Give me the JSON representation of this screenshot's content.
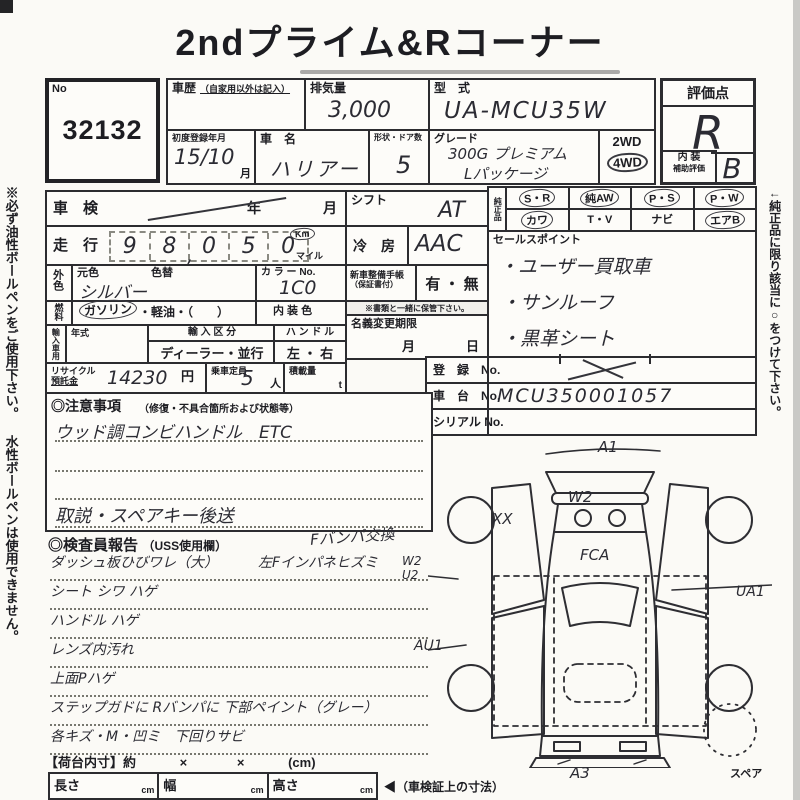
{
  "page": {
    "title": "2ndプライム&Rコーナー",
    "left_margin_note": "※必ず油性ボールペンをご使用下さい。 水性ボールペンは使用できません。",
    "right_margin_note": "←純正品に限り該当に○をつけて下さい。",
    "ink_color": "#2c2c30",
    "paper_color": "#fbfaf6"
  },
  "lot": {
    "label": "No",
    "number": "32132"
  },
  "top": {
    "history_label_1": "車歴",
    "history_label_2": "（自家用以外は記入）",
    "displacement_label": "排気量",
    "displacement_value": "3,000",
    "model_label": "型　式",
    "model_value": "UA-MCU35W",
    "first_reg_label": "初度登録年月",
    "first_reg_value": "15∕10",
    "first_reg_unit": "月",
    "name_label": "車　名",
    "name_value": "ハリアー",
    "shape_label": "形状・ドア数",
    "shape_value": "5",
    "grade_label": "グレード",
    "grade_value_1": "300G プレミアム",
    "grade_value_2": "Lパッケージ",
    "wd2": "2WD",
    "wd4": "4WD"
  },
  "score": {
    "label": "評価点",
    "value": "R",
    "interior_label_1": "内 装",
    "interior_label_2": "補助評価",
    "interior_value": "B"
  },
  "left": {
    "shaken_label": "車　検",
    "year_label": "年",
    "month_label": "月",
    "mileage_label": "走　行",
    "mileage": {
      "d": [
        "9",
        "8",
        "0",
        "5",
        "0"
      ],
      "comma": ","
    },
    "unit_km": "Km",
    "unit_mile": "マイル",
    "ext_color_label": "外色",
    "base_color_label": "元色",
    "color_change_label": "色替",
    "base_color_value": "シルバー",
    "color_no_label": "カ ラ ー No.",
    "color_no_value": "1C0",
    "fuel_label": "燃料",
    "fuel_opt_main": "ガソリン",
    "fuel_opt_rest": "・軽油・（　　）",
    "interior_color_label": "内 装 色",
    "import_label": "輸入車用",
    "year2_label": "年式",
    "import_div_label": "輸 入 区 分",
    "import_div_value": "ディーラー・並行",
    "handle_label": "ハ ン ド ル",
    "handle_value": "左 ・ 右",
    "recycle_label_1": "リサイクル",
    "recycle_label_2": "預託金",
    "recycle_value": "14230",
    "recycle_unit": "円",
    "capacity_label": "乗車定員",
    "capacity_value": "5",
    "capacity_unit": "人",
    "load_label": "積載量",
    "load_unit": "t"
  },
  "mid": {
    "shift_label": "シフト",
    "shift_value": "AT",
    "ac_label": "冷　房",
    "ac_value": "AAC",
    "manual_label_1": "新車整備手帳",
    "manual_label_2": "（保証書付）",
    "manual_value": "有 ・ 無",
    "manual_note": "※書類と一緒に保管下さい。",
    "transfer_label": "名義変更期限",
    "transfer_month": "月",
    "transfer_day": "日"
  },
  "oem": {
    "group_label": "純正品",
    "cells": [
      {
        "top": "S・R",
        "bottom": "カワ"
      },
      {
        "top": "純AW",
        "bottom": "T・V"
      },
      {
        "top": "P・S",
        "bottom": "ナビ"
      },
      {
        "top": "P・W",
        "bottom": "エアB"
      }
    ]
  },
  "sales": {
    "label": "セールスポイント",
    "items": [
      "・ユーザー買取車",
      "・サンルーフ",
      "・黒革シート"
    ]
  },
  "reg": {
    "reg_label": "登　録　No.",
    "chassis_label": "車　台　No.",
    "chassis_value": "MCU350001057",
    "serial_label": "シリアル No."
  },
  "cautions": {
    "label": "◎注意事項",
    "label_sub": "（修復・不具合箇所および状態等）",
    "line_1": "ウッド調コンビハンドル　ETC",
    "line_4": "取説・スペアキー後送"
  },
  "inspector": {
    "label": "◎検査員報告",
    "label_sub": "（USS使用欄）",
    "header_note": "Fバンパ交換",
    "lines": [
      {
        "left": "ダッシュ板ひびワレ（大）",
        "right": "左Fインパネヒズミ"
      },
      {
        "left": "シート シワ ハゲ",
        "right": ""
      },
      {
        "left": "ハンドル ハゲ",
        "right": ""
      },
      {
        "left": "レンズ内汚れ",
        "right": ""
      },
      {
        "left": "上面Pハゲ",
        "right": ""
      },
      {
        "left": "ステップガドに Rバンパに 下部ペイント（グレー）",
        "right": ""
      },
      {
        "left": "各キズ・M・凹ミ　下回りサビ",
        "right": ""
      }
    ]
  },
  "diagram": {
    "labels": {
      "a1": "A1",
      "w2_hood": "W2",
      "xx": "XX",
      "fca": "FCA",
      "w2_side": "W2",
      "u2_side": "U2",
      "ua1": "UA1",
      "au1": "AU1",
      "a3": "A3",
      "spare": "スペア"
    }
  },
  "bed": {
    "label": "【荷台内寸】約",
    "x1": "×",
    "x2": "×",
    "unit": "(cm)"
  },
  "dims": {
    "length_label": "長さ",
    "width_label": "幅",
    "height_label": "高さ",
    "unit": "cm",
    "note": "◀（車検証上の寸法）"
  }
}
